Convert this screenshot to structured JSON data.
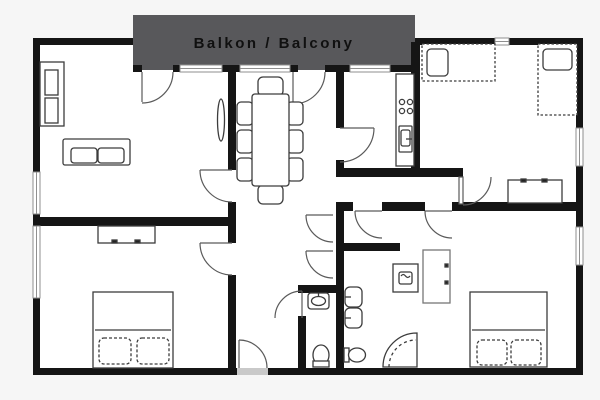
{
  "balcony": {
    "label": "Balkon / Balcony"
  },
  "colors": {
    "background": "#f6f6f6",
    "floor": "#ffffff",
    "wall": "#151515",
    "balcony_fill": "#58585b",
    "balcony_text": "#101010",
    "furniture_stroke": "#3c3c3c",
    "light_furniture_stroke": "#777777",
    "door_stroke": "#5a5a5a",
    "window_frame": "#8f8f8f",
    "threshold": "#c9c9c9"
  },
  "furniture": [
    "shelf-cabinet",
    "sofa",
    "radiator",
    "dining-table",
    "dining-chairs",
    "kitchen-counter",
    "stove-burners",
    "kitchen-sink",
    "single-bed",
    "single-bed",
    "desk",
    "double-bed",
    "dresser",
    "wardrobe",
    "double-bed",
    "washing-machine",
    "corner-shower",
    "bathroom-sink",
    "bathroom-sink",
    "toilet",
    "wc-sink",
    "wc-toilet"
  ]
}
